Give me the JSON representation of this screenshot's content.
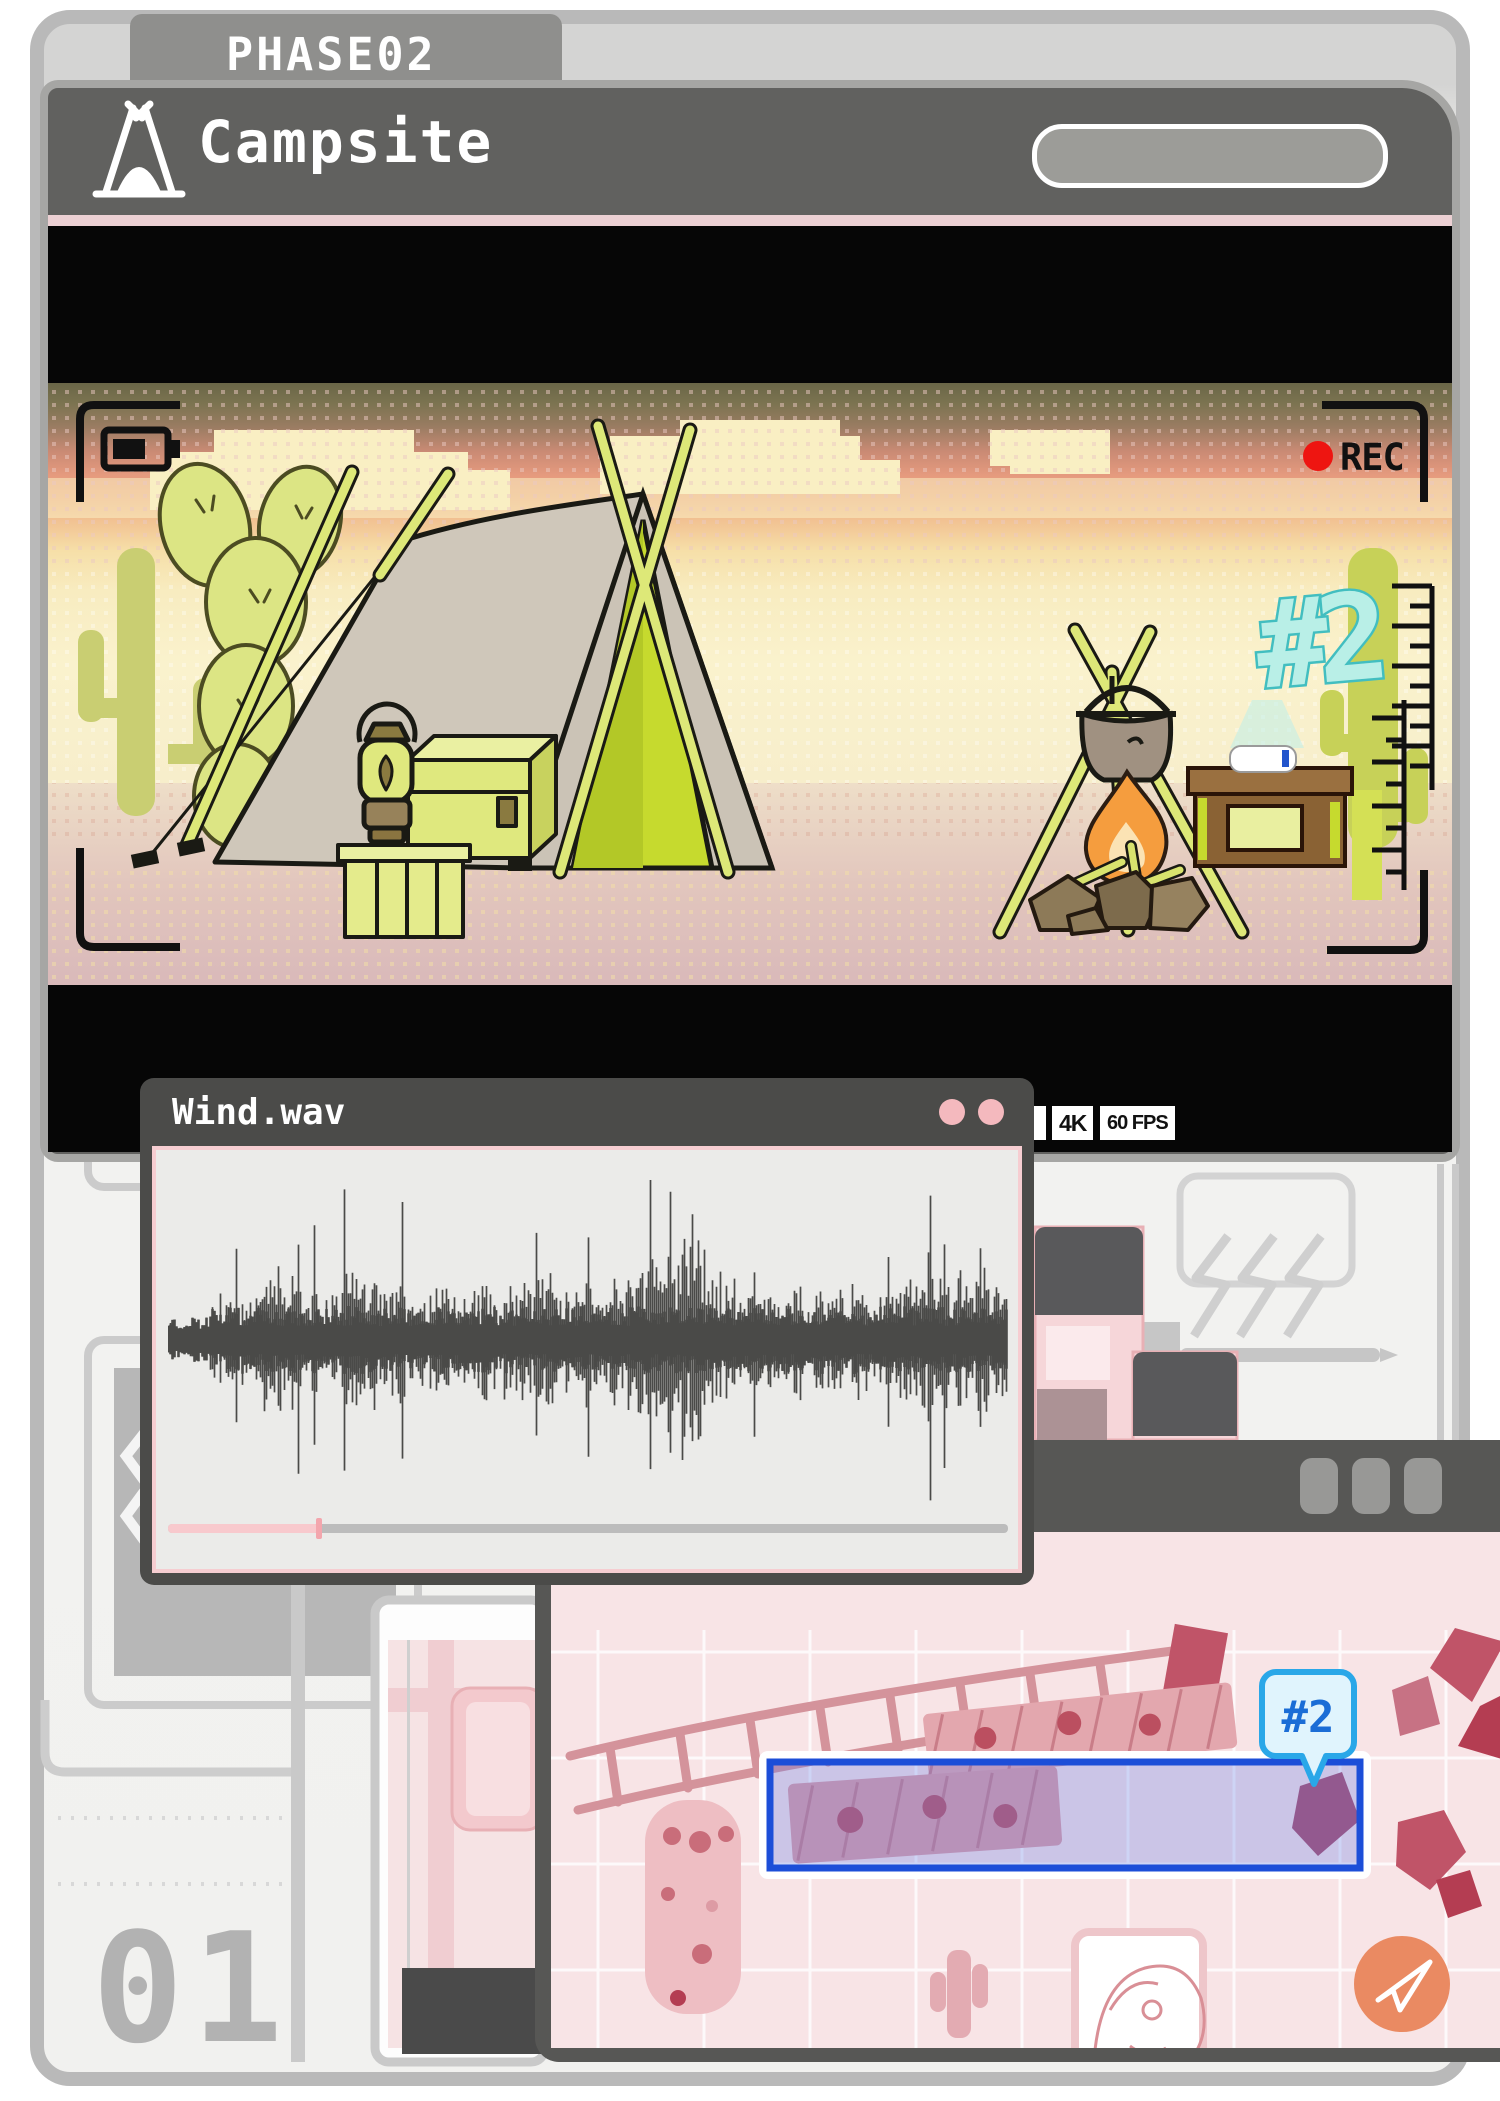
{
  "page": {
    "tab_label": "PHASE02",
    "page_number": "01"
  },
  "campsite_window": {
    "title": "Campsite",
    "icon": "tent-icon"
  },
  "viewfinder": {
    "rec_label": "REC",
    "battery_icon": "battery-icon",
    "hologram_label": "#2",
    "badges": [
      "4K",
      "60 FPS"
    ]
  },
  "audio_window": {
    "title": "Wind.wav",
    "button_icons": [
      "window-dot-icon",
      "window-dot-icon"
    ],
    "progress_fraction": 0.18,
    "waveform": {
      "envelope": [
        0.1,
        0.12,
        0.16,
        0.3,
        0.22,
        0.38,
        0.45,
        0.3,
        0.25,
        0.35,
        0.4,
        0.38,
        0.3,
        0.26,
        0.32,
        0.28,
        0.35,
        0.3,
        0.38,
        0.42,
        0.36,
        0.3,
        0.42,
        0.38,
        0.45,
        0.55,
        0.75,
        0.6,
        0.45,
        0.38,
        0.3,
        0.28,
        0.33,
        0.3,
        0.28,
        0.35,
        0.3,
        0.28,
        0.4,
        0.55,
        0.45,
        0.38,
        0.42,
        0.35
      ],
      "spikes": [
        [
          0.08,
          0.55
        ],
        [
          0.155,
          0.75
        ],
        [
          0.175,
          0.8
        ],
        [
          0.21,
          0.85
        ],
        [
          0.28,
          0.8
        ],
        [
          0.44,
          0.75
        ],
        [
          0.5,
          0.85
        ],
        [
          0.575,
          1.0
        ],
        [
          0.6,
          0.95
        ],
        [
          0.625,
          0.9
        ],
        [
          0.7,
          0.6
        ],
        [
          0.86,
          0.7
        ],
        [
          0.91,
          1.0
        ],
        [
          0.925,
          0.85
        ],
        [
          0.97,
          0.6
        ]
      ]
    }
  },
  "map_window": {
    "marker_label": "#2",
    "title_button_icons": [
      "window-button-icon",
      "window-button-icon",
      "window-button-icon"
    ],
    "send_icon": "paper-plane-icon"
  },
  "colors": {
    "accent_pink": "#f4b9be",
    "selection_blue": "#1c4ed8",
    "bubble_blue": "#2aa7e8",
    "hologram_cyan": "#42bec0",
    "rec_red": "#ee1511",
    "send_orange": "#ea8a62",
    "title_bar_gray": "#61615f"
  }
}
